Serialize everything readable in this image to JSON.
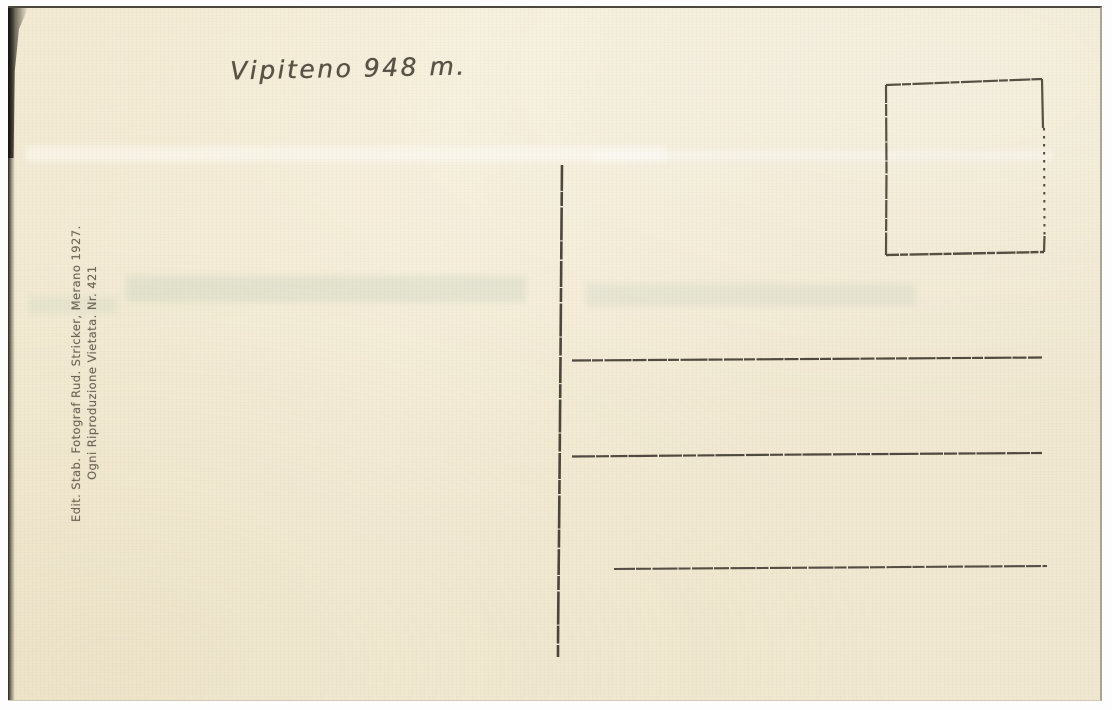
{
  "card": {
    "title": "Vipiteno 948 m.",
    "imprint": {
      "line1": "Edit. Stab. Fotograf Rud. Stricker, Merano 1927.",
      "line2": "Ogni Riproduzione Vietata. Nr. 421"
    },
    "elements": {
      "stamp_box": "empty stamp box, upper right",
      "center_divider": "vertical rule separating message and address sides",
      "address_line_count": 3
    },
    "colors": {
      "paper": "#f2ead3",
      "ink": "#3b332b",
      "title_ink": "#585146",
      "imprint_ink": "#6e6759",
      "scan_edge": "#16140f",
      "frame": "#fdfdfd"
    }
  }
}
